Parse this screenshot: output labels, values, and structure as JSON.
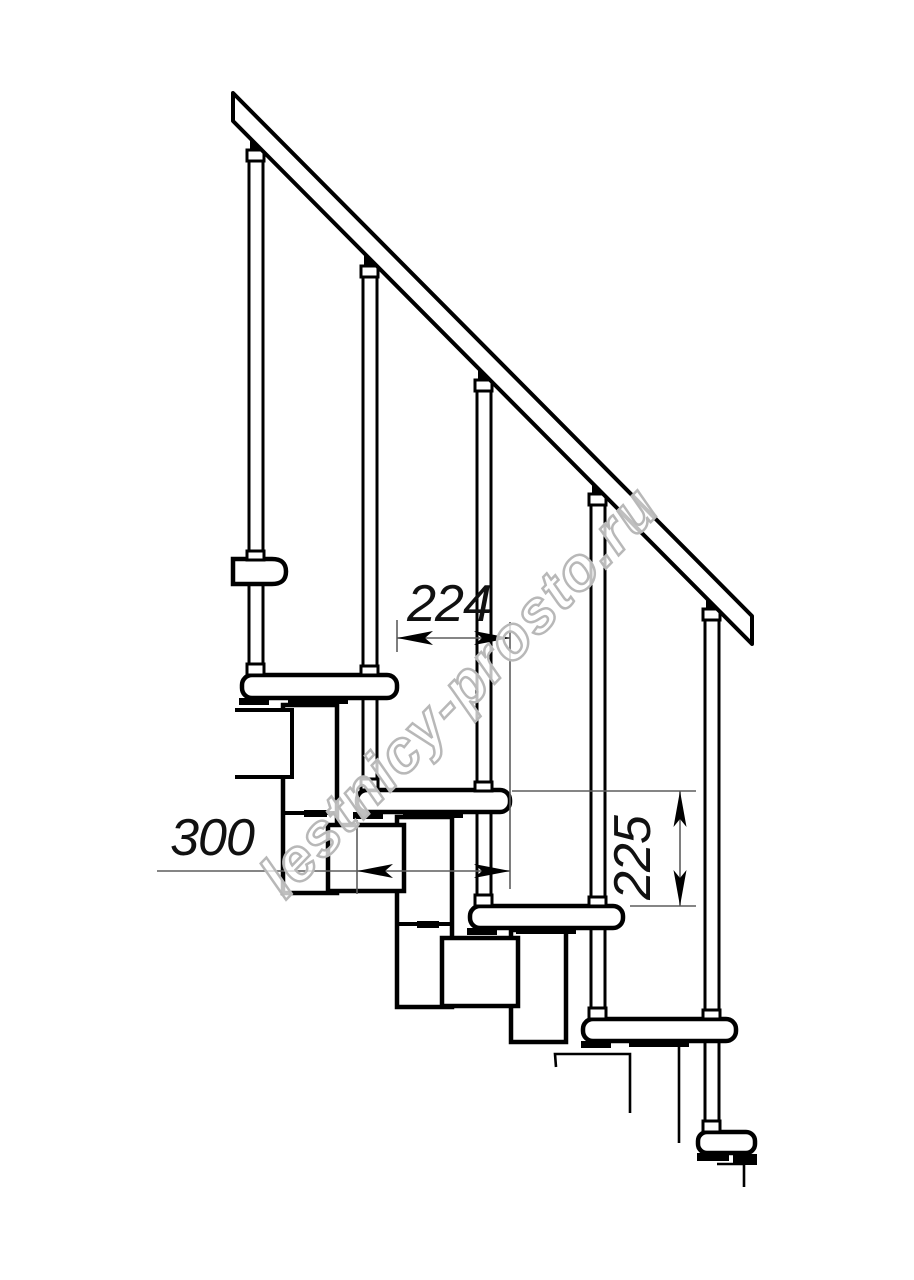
{
  "watermark": {
    "text": "lestnicy-prosto.ru"
  },
  "dimensions": {
    "run": {
      "value": "224",
      "orientation": "horizontal"
    },
    "depth": {
      "value": "300",
      "orientation": "horizontal"
    },
    "rise": {
      "value": "225",
      "orientation": "vertical"
    }
  },
  "colors": {
    "line": "#000000",
    "dim_line": "#5d5d5d",
    "watermark_stroke": "#b8b8b8",
    "background": "#ffffff"
  }
}
